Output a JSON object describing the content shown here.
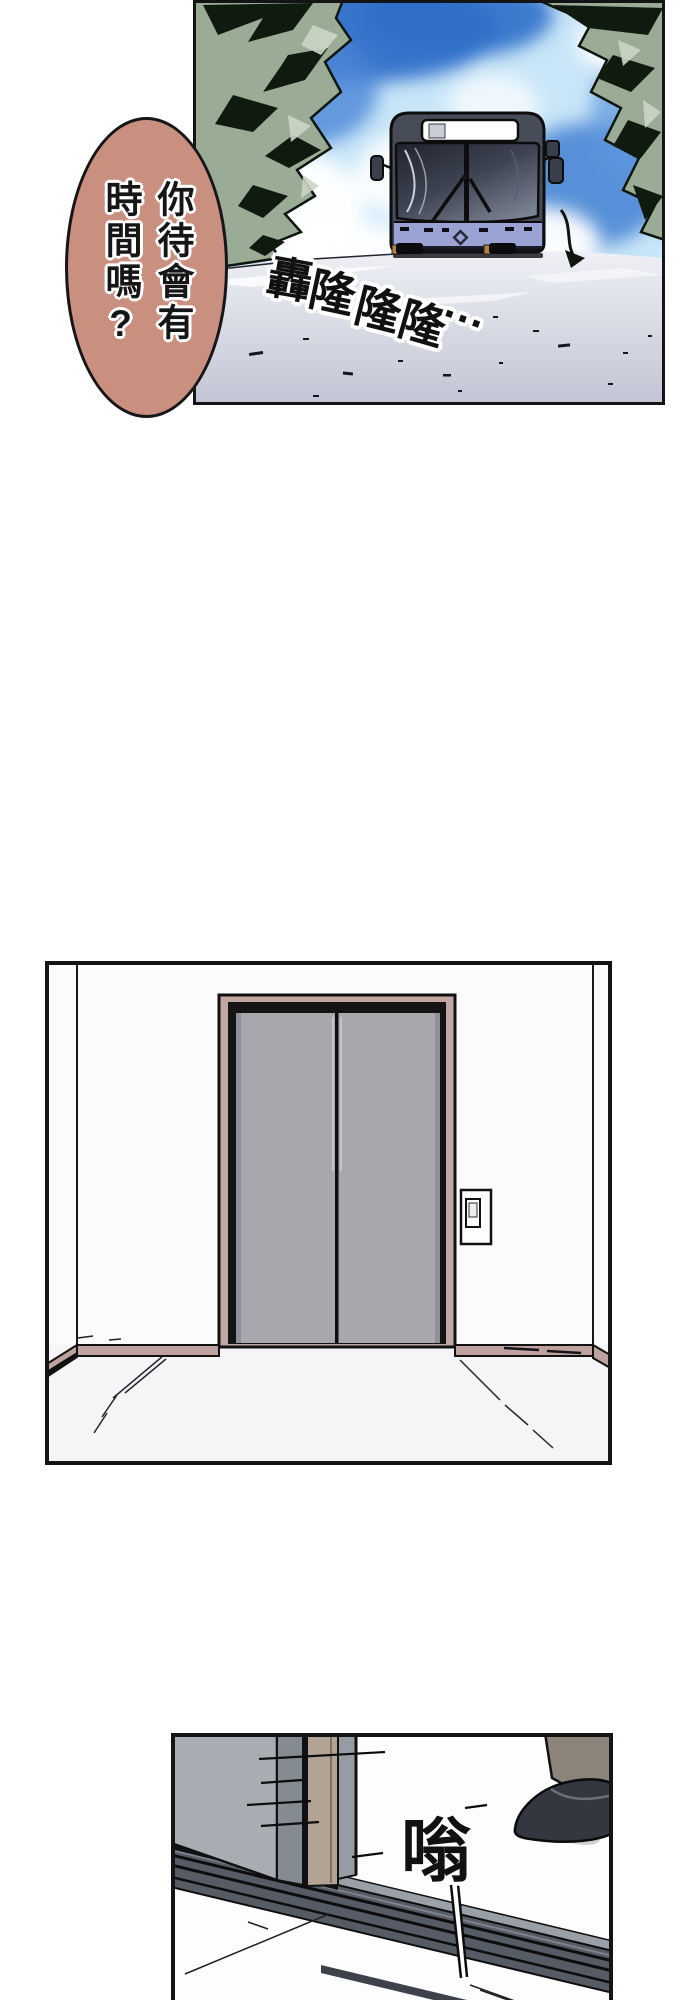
{
  "page": {
    "width": 690,
    "height": 2000,
    "panel_count": 3
  },
  "panel_top": {
    "speech_bubble": {
      "text": "你待會有時間嗎?",
      "column_right": "你待會有",
      "column_left": "時間嗎?"
    },
    "sfx_rumble": {
      "text": "轟隆隆隆...",
      "chars": [
        "轟",
        "隆",
        "隆",
        "隆"
      ],
      "dots": "..."
    }
  },
  "panel_middle": {},
  "panel_bottom": {
    "sfx_buzz": {
      "text": "嗡"
    }
  },
  "colors": {
    "page_bg": "#ffffff",
    "panel_border": "#141414",
    "bubble_fill": "#c9907f",
    "sky_base": "#c9e6f8",
    "sky_deep": "#2f6fc9",
    "cloud_white": "#ffffff",
    "foliage_base": "#9aab96",
    "foliage_dark": "#101b10",
    "foliage_light": "#ccd6c6",
    "road_base": "#c2c4d4",
    "bus_body": "#474c59",
    "bus_lower": "#9aa1d3",
    "bus_sign": "#ffffff",
    "wall_white": "#fbfbfc",
    "frame_mauve": "#c1a6a1",
    "baseboard_mauve": "#bda29d",
    "door_gray": "#a7a7ad",
    "door_edge": "#8f8f97",
    "floor_white": "#f5f5f7",
    "track_dark": "#565c66",
    "track_light": "#9aa0a8",
    "closeup_door": "#a9adb3",
    "closeup_door_edge": "#858b93",
    "jamb_tan": "#b2a395",
    "strip_gray": "#969ca3",
    "shoe_black": "#33373f",
    "ankle_taupe": "#8c837a"
  }
}
